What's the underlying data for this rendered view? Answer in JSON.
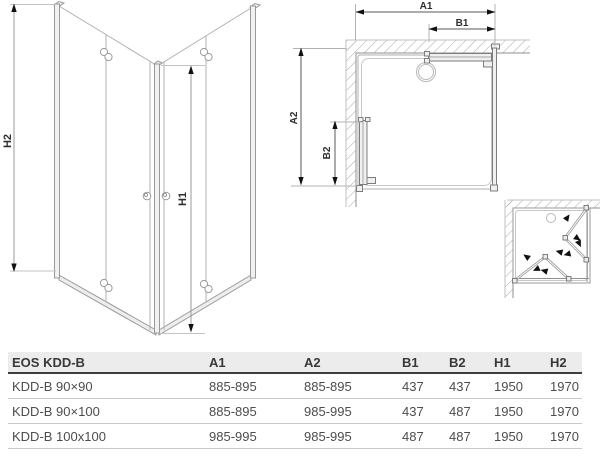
{
  "perspective_view": {
    "h1_label": "H1",
    "h2_label": "H2"
  },
  "plan_view": {
    "a1_label": "A1",
    "b1_label": "B1",
    "a2_label": "A2",
    "b2_label": "B2"
  },
  "table": {
    "header": [
      "EOS KDD-B",
      "A1",
      "A2",
      "B1",
      "B2",
      "H1",
      "H2"
    ],
    "rows": [
      [
        "KDD-B 90×90",
        "885-895",
        "885-895",
        "437",
        "437",
        "1950",
        "1970"
      ],
      [
        "KDD-B 90×100",
        "885-895",
        "985-995",
        "437",
        "487",
        "1950",
        "1970"
      ],
      [
        "KDD-B 100x100",
        "985-995",
        "985-995",
        "487",
        "487",
        "1950",
        "1970"
      ]
    ]
  },
  "colors": {
    "background": "#ffffff",
    "glass_line": "#b0b0b0",
    "profile_line": "#8f8f8f",
    "dimension_line": "#9a9a9a",
    "arrow": "#111111",
    "label_text": "#2e2e2e",
    "table_header_bg": "#ececec",
    "table_header_border": "#3f3f3f",
    "table_row_divider": "#c9c9c9",
    "table_text": "#4d4d4d"
  }
}
